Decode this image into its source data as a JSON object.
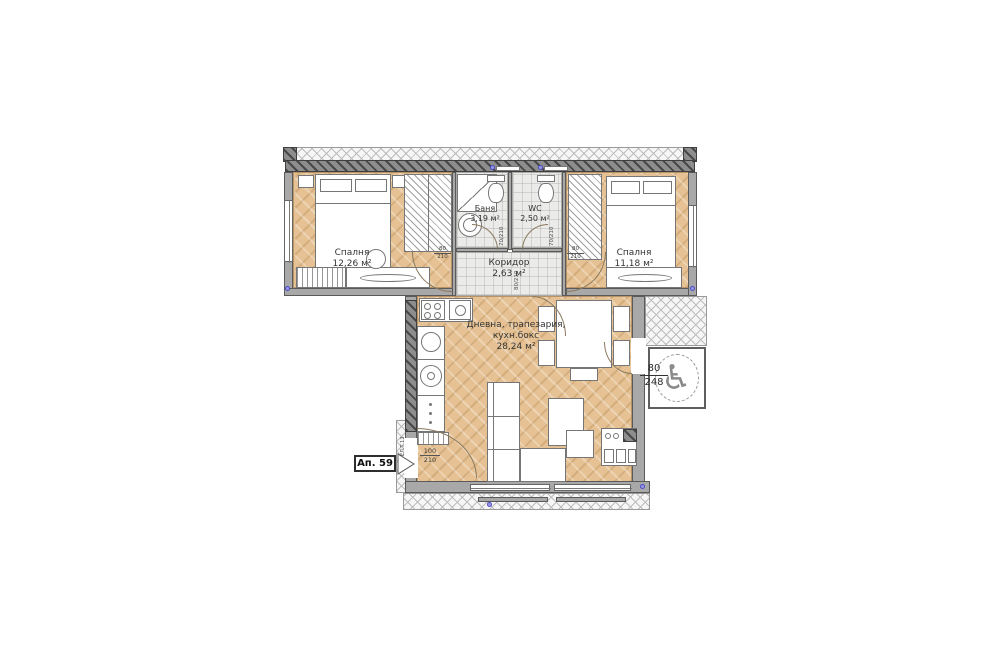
{
  "plan": {
    "apartment_badge": "Ап. 59",
    "rooms": {
      "bedroom_left": {
        "name": "Спалня",
        "area": "12,26 м²"
      },
      "bath": {
        "name": "Баня",
        "area": "3,19 м²"
      },
      "wc": {
        "name": "WC",
        "area": "2,50 м²"
      },
      "corridor": {
        "name": "Коридор",
        "area": "2,63 м²"
      },
      "bedroom_right": {
        "name": "Спалня",
        "area": "11,18 м²"
      },
      "living": {
        "name_line1": "Дневна, трапезария,",
        "name_line2": "кухн.бокс",
        "area": "28,24 м²"
      }
    },
    "doors": {
      "bedroom_left_w": "80",
      "bedroom_left_h": "210",
      "bedroom_right_w": "80",
      "bedroom_right_h": "210",
      "bath": "70/210",
      "wc": "70/210",
      "living": "80/210",
      "entrance_w": "100",
      "entrance_h": "210",
      "common_w": "80",
      "common_h": "248"
    },
    "panel_label": "ЕЛ.Т.13",
    "icons": {
      "accessibility": "♿"
    },
    "colors": {
      "wood": "#e5c193",
      "tile": "#ebebe9",
      "wall": "#a8a8a8",
      "wall_dark": "#6e6e6e",
      "outline": "#555555",
      "window_marker": "#4a4acc"
    }
  }
}
